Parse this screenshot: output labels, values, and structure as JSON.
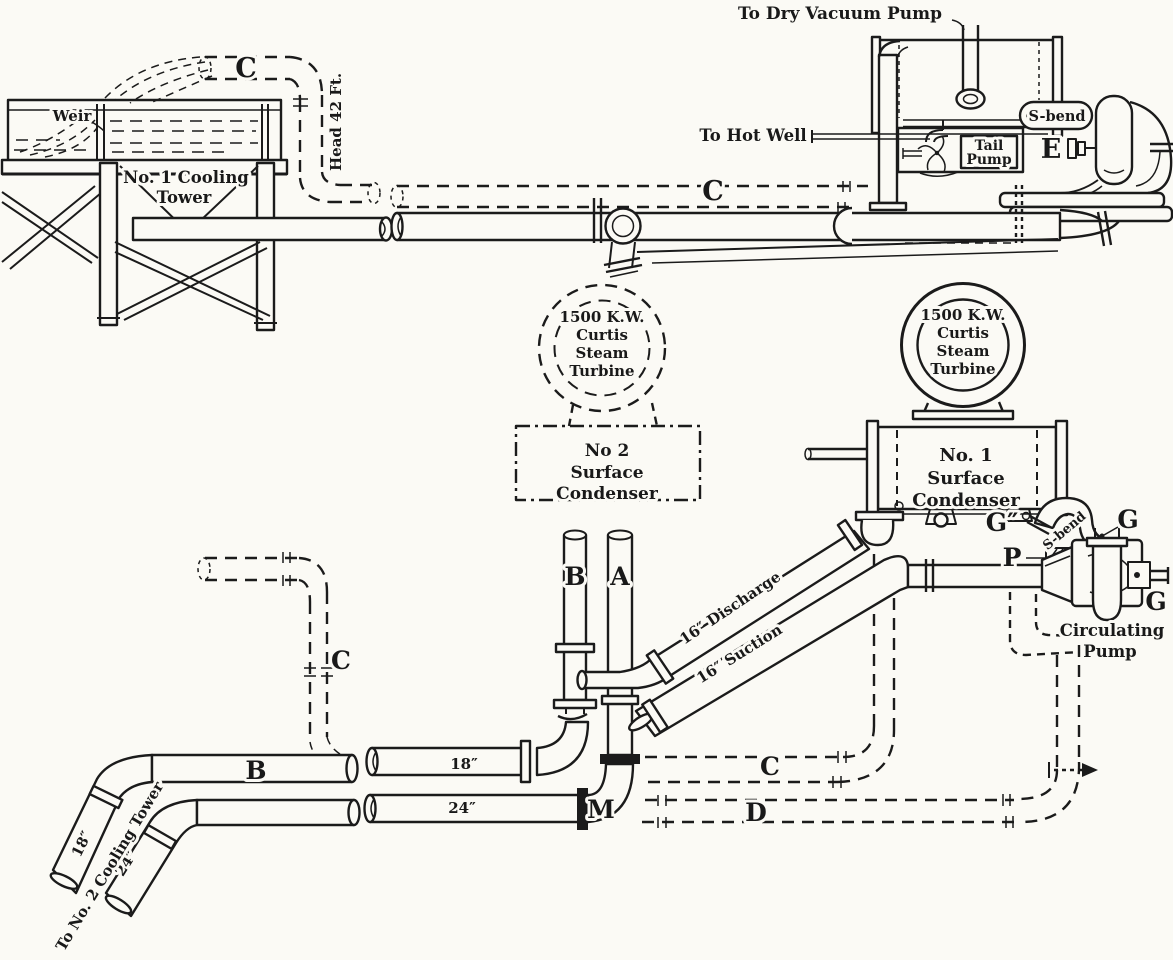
{
  "figure": {
    "kind": "engineering-piping-diagram",
    "caption": "Condensing plant piping with cooling tower, surface condensers, tail pump and circulating pumps",
    "ink_color": "#1b1b1b",
    "paper_color": "#fbfaf5"
  },
  "cooling_tower": {
    "weir": "Weir",
    "name_line1": "No. 1 Cooling",
    "name_line2": "Tower",
    "head": "Head 42 Ft.",
    "pipe_label": "C"
  },
  "side_view": {
    "to_dry_vacuum_pump": "To Dry Vacuum Pump",
    "to_hot_well": "To Hot Well",
    "tail_pump_line1": "Tail",
    "tail_pump_line2": "Pump",
    "s_bend": "S-bend",
    "valve": "E",
    "main_label": "C"
  },
  "turbine_no2": {
    "lines": [
      "1500 K.W.",
      "Curtis",
      "Steam",
      "Turbine"
    ]
  },
  "condenser_no2": {
    "lines": [
      "No 2",
      "Surface",
      "Condenser"
    ]
  },
  "turbine_no1": {
    "lines": [
      "1500 K.W.",
      "Curtis",
      "Steam",
      "Turbine"
    ]
  },
  "condenser_no1": {
    "lines": [
      "No. 1",
      "Surface",
      "Condenser"
    ]
  },
  "pump_area": {
    "g_top": "G″",
    "s_bend": "S-bend",
    "g_right": "G",
    "p": "P",
    "g_shaft": "G",
    "name_line1": "Circulating",
    "name_line2": "Pump"
  },
  "pipes": {
    "a": "A",
    "b_riser": "B",
    "b_main": "B",
    "discharge": "16″ Discharge",
    "suction": "16″ Suction",
    "c_riser": "C",
    "c_return": "C",
    "d_return": "D",
    "m_elbow": "M",
    "main_18": "18″",
    "main_24": "24″",
    "branch_18": "18″",
    "branch_24": "24″",
    "to_no2_tower": "To No. 2 Cooling Tower"
  }
}
